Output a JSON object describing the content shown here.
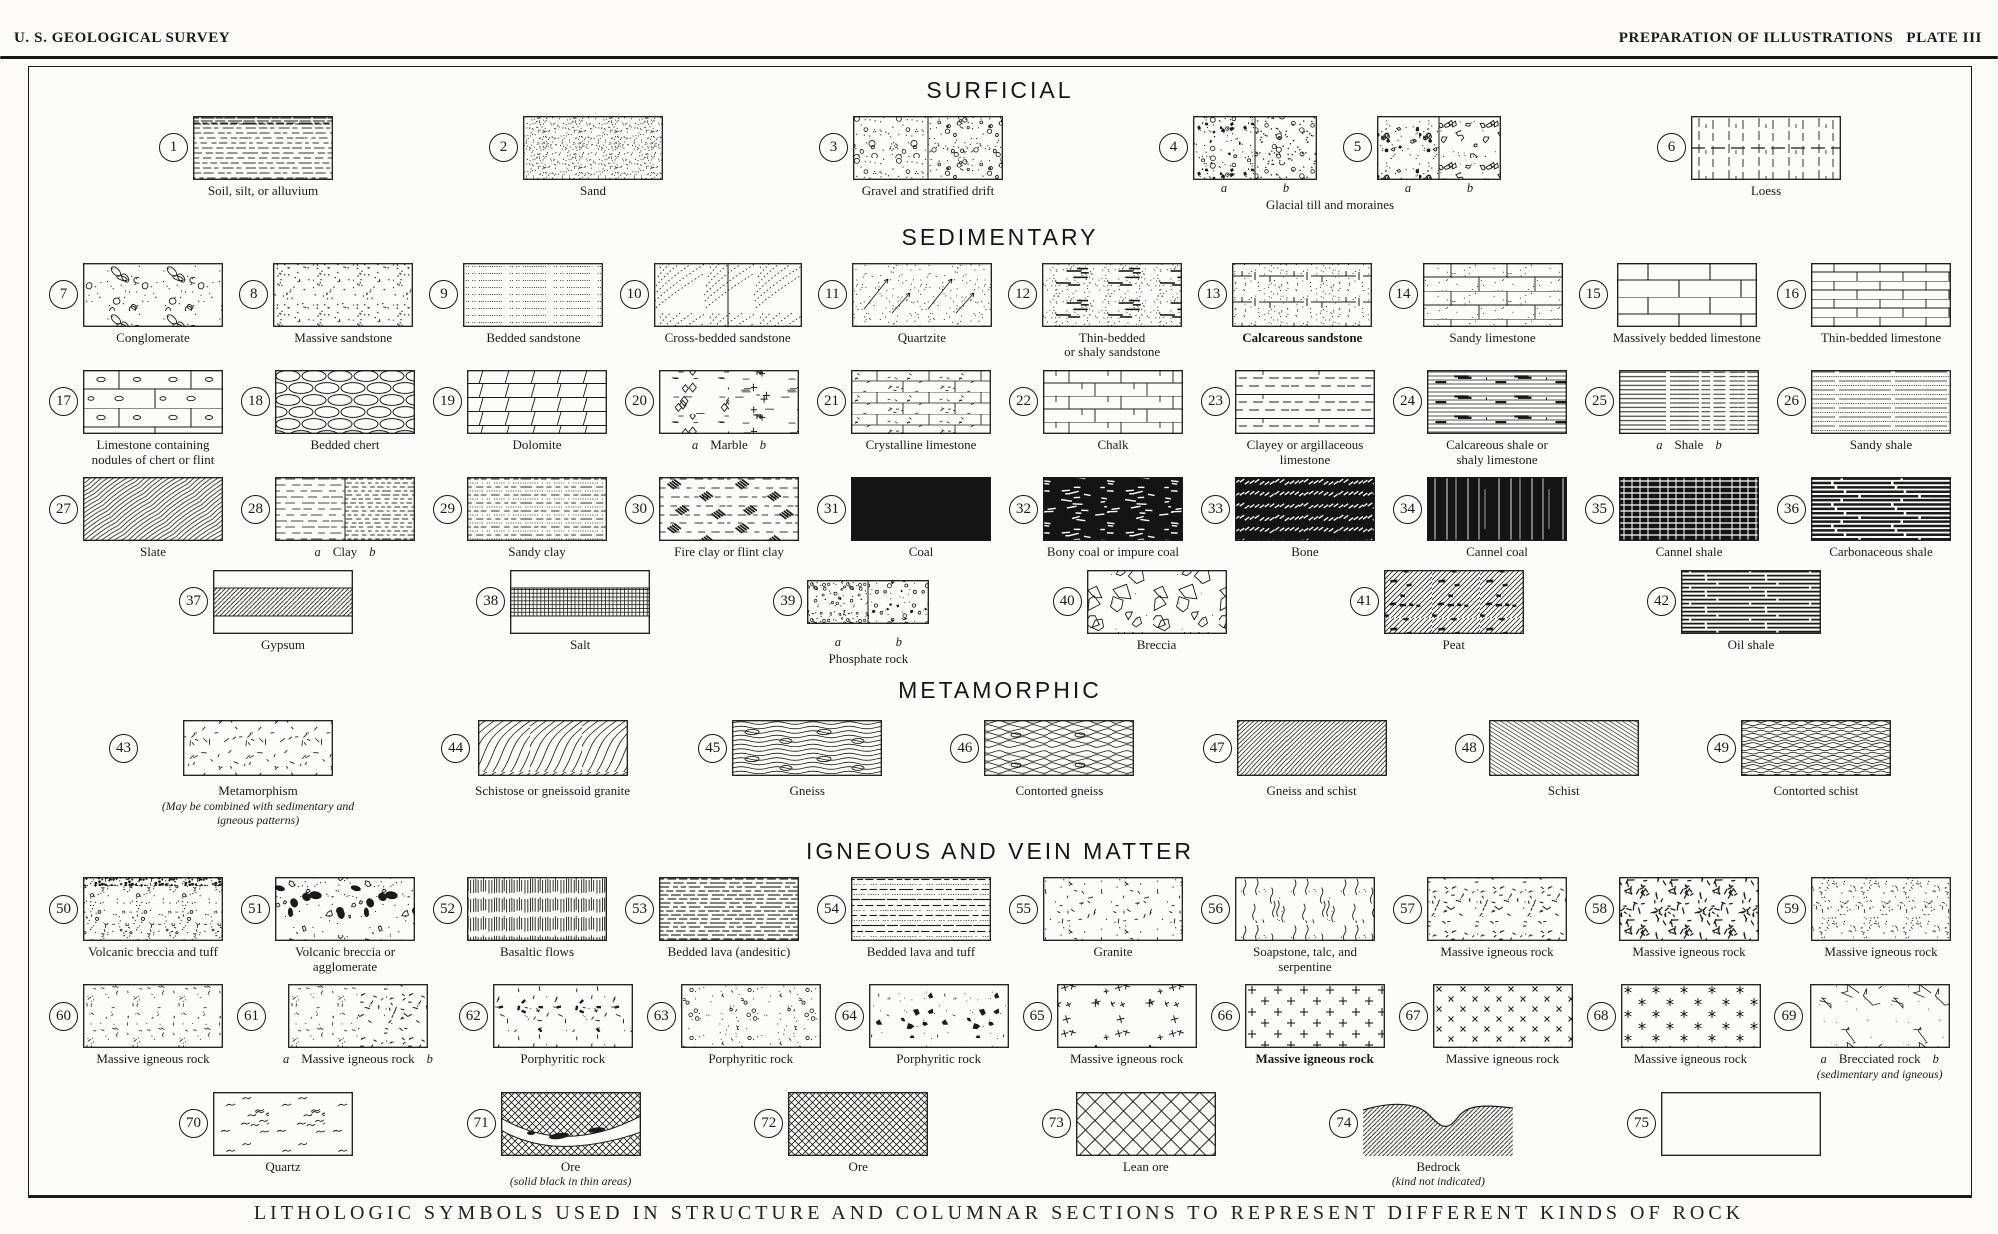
{
  "header": {
    "left": "U. S. GEOLOGICAL SURVEY",
    "right": "PREPARATION OF ILLUSTRATIONS   PLATE III"
  },
  "caption": "LITHOLOGIC SYMBOLS USED IN STRUCTURE AND COLUMNAR SECTIONS TO REPRESENT DIFFERENT KINDS OF ROCK",
  "ink_color": "#1a1a1a",
  "paper_color": "#fcfcfa",
  "sections": [
    {
      "title": "SURFICIAL",
      "rows": [
        [
          {
            "num": 1,
            "label": "Soil, silt, or alluvium",
            "patterns": [
              "soil"
            ],
            "top": "soilTop"
          },
          {
            "num": 2,
            "label": "Sand",
            "patterns": [
              "stipFine"
            ]
          },
          {
            "num": 3,
            "label": "Gravel and stratified drift",
            "split": true,
            "patterns": [
              "gravelA",
              "gravelB"
            ],
            "w": 150
          },
          {
            "pair": true,
            "label": "Glacial till and moraines",
            "items": [
              {
                "num": 4,
                "split": true,
                "ab": "row",
                "patterns": [
                  "tillA",
                  "tillB"
                ],
                "w": 124
              },
              {
                "num": 5,
                "split": true,
                "ab": "row",
                "patterns": [
                  "tillC",
                  "tillD"
                ],
                "w": 124
              }
            ]
          },
          {
            "num": 6,
            "label": "Loess",
            "patterns": [
              "loess"
            ],
            "mid": true,
            "w": 150
          }
        ]
      ]
    },
    {
      "title": "SEDIMENTARY",
      "rows": [
        [
          {
            "num": 7,
            "label": "Conglomerate",
            "patterns": [
              "conglom"
            ]
          },
          {
            "num": 8,
            "label": "Massive sandstone",
            "patterns": [
              "stipSparse"
            ]
          },
          {
            "num": 9,
            "label": "Bedded sandstone",
            "patterns": [
              "dotRows"
            ]
          },
          {
            "num": 10,
            "label": "Cross-bedded sandstone",
            "split": true,
            "patterns": [
              "crossbed",
              "crossbed"
            ],
            "w": 148
          },
          {
            "num": 11,
            "label": "Quartzite",
            "patterns": [
              "quartzite"
            ]
          },
          {
            "num": 12,
            "label": "Thin-bedded",
            "label2": "or shaly sandstone",
            "patterns": [
              "shalySS"
            ]
          },
          {
            "num": 13,
            "label": "Calcareous sandstone",
            "bold": true,
            "patterns": [
              "calcSS"
            ]
          },
          {
            "num": 14,
            "label": "Sandy limestone",
            "patterns": [
              "sandyLS"
            ]
          },
          {
            "num": 15,
            "label": "Massively bedded limestone",
            "patterns": [
              "brickL"
            ]
          },
          {
            "num": 16,
            "label": "Thin-bedded limestone",
            "patterns": [
              "brickT"
            ]
          }
        ],
        [
          {
            "num": 17,
            "label": "Limestone containing",
            "label2": "nodules of chert or flint",
            "patterns": [
              "brickNod"
            ]
          },
          {
            "num": 18,
            "label": "Bedded chert",
            "patterns": [
              "chert"
            ]
          },
          {
            "num": 19,
            "label": "Dolomite",
            "patterns": [
              "dolomite"
            ]
          },
          {
            "num": 20,
            "label": "Marble",
            "ab": "label",
            "split": true,
            "divider": false,
            "patterns": [
              "marbleA",
              "marbleB"
            ]
          },
          {
            "num": 21,
            "label": "Crystalline limestone",
            "patterns": [
              "crystLS"
            ]
          },
          {
            "num": 22,
            "label": "Chalk",
            "patterns": [
              "chalk"
            ]
          },
          {
            "num": 23,
            "label": "Clayey or argillaceous",
            "label2": "limestone",
            "patterns": [
              "clayeyLS"
            ]
          },
          {
            "num": 24,
            "label": "Calcareous shale or",
            "label2": "shaly limestone",
            "patterns": [
              "calcShale"
            ]
          },
          {
            "num": 25,
            "label": "Shale",
            "ab": "label",
            "split": true,
            "divider": false,
            "patterns": [
              "shaleA",
              "shaleB"
            ]
          },
          {
            "num": 26,
            "label": "Sandy shale",
            "patterns": [
              "sandyShale"
            ]
          }
        ],
        [
          {
            "num": 27,
            "label": "Slate",
            "patterns": [
              "slate"
            ]
          },
          {
            "num": 28,
            "label": "Clay",
            "ab": "label",
            "split": true,
            "patterns": [
              "clayA",
              "clayB"
            ]
          },
          {
            "num": 29,
            "label": "Sandy clay",
            "patterns": [
              "sandyClay"
            ]
          },
          {
            "num": 30,
            "label": "Fire clay or flint clay",
            "patterns": [
              "fireclay"
            ]
          },
          {
            "num": 31,
            "label": "Coal",
            "patterns": [
              "solid"
            ]
          },
          {
            "num": 32,
            "label": "Bony coal or impure coal",
            "patterns": [
              "bonyCoal"
            ]
          },
          {
            "num": 33,
            "label": "Bone",
            "patterns": [
              "bone"
            ]
          },
          {
            "num": 34,
            "label": "Cannel coal",
            "patterns": [
              "cannelC"
            ]
          },
          {
            "num": 35,
            "label": "Cannel shale",
            "patterns": [
              "cannelS"
            ]
          },
          {
            "num": 36,
            "label": "Carbonaceous shale",
            "patterns": [
              "carbShale"
            ]
          }
        ],
        [
          {
            "num": 37,
            "label": "Gypsum",
            "band": true,
            "patterns": [
              "diagBand"
            ]
          },
          {
            "num": 38,
            "label": "Salt",
            "band": true,
            "patterns": [
              "gridBand"
            ]
          },
          {
            "num": 39,
            "label": "Phosphate rock",
            "ab": "row",
            "split": true,
            "patterns": [
              "phosA",
              "phosB"
            ],
            "w": 122,
            "h": 44
          },
          {
            "num": 40,
            "label": "Breccia",
            "patterns": [
              "breccia"
            ]
          },
          {
            "num": 41,
            "label": "Peat",
            "patterns": [
              "peat"
            ]
          },
          {
            "num": 42,
            "label": "Oil shale",
            "patterns": [
              "oilShale"
            ]
          }
        ]
      ]
    },
    {
      "title": "METAMORPHIC",
      "rows": [
        [
          {
            "num": 43,
            "label": "Metamorphism",
            "note": "(May be combined with sedimentary and igneous patterns)",
            "patterns": [
              "metam"
            ],
            "w": 150,
            "h": 56
          },
          {
            "num": 44,
            "label": "Schistose or gneissoid granite",
            "patterns": [
              "schGran"
            ],
            "w": 150,
            "h": 56
          },
          {
            "num": 45,
            "label": "Gneiss",
            "patterns": [
              "gneiss"
            ],
            "w": 150,
            "h": 56
          },
          {
            "num": 46,
            "label": "Contorted gneiss",
            "patterns": [
              "contGneiss"
            ],
            "w": 150,
            "h": 56
          },
          {
            "num": 47,
            "label": "Gneiss and schist",
            "patterns": [
              "gneissSch"
            ],
            "w": 150,
            "h": 56
          },
          {
            "num": 48,
            "label": "Schist",
            "patterns": [
              "schist"
            ],
            "w": 150,
            "h": 56
          },
          {
            "num": 49,
            "label": "Contorted schist",
            "patterns": [
              "contSchist"
            ],
            "w": 150,
            "h": 56
          }
        ]
      ]
    },
    {
      "title": "IGNEOUS AND VEIN MATTER",
      "rows": [
        [
          {
            "num": 50,
            "label": "Volcanic breccia and tuff",
            "patterns": [
              "vtuff"
            ],
            "top": "vtuffTop"
          },
          {
            "num": 51,
            "label": "Volcanic breccia or",
            "label2": "agglomerate",
            "patterns": [
              "agglom"
            ]
          },
          {
            "num": 52,
            "label": "Basaltic flows",
            "patterns": [
              "basalt"
            ]
          },
          {
            "num": 53,
            "label": "Bedded lava (andesitic)",
            "patterns": [
              "lavaA"
            ]
          },
          {
            "num": 54,
            "label": "Bedded lava and tuff",
            "patterns": [
              "lavaTuff"
            ]
          },
          {
            "num": 55,
            "label": "Granite",
            "patterns": [
              "granite"
            ]
          },
          {
            "num": 56,
            "label": "Soapstone, talc, and",
            "label2": "serpentine",
            "patterns": [
              "soap"
            ]
          },
          {
            "num": 57,
            "label": "Massive igneous rock",
            "patterns": [
              "mig57"
            ]
          },
          {
            "num": 58,
            "label": "Massive igneous rock",
            "patterns": [
              "mig58"
            ]
          },
          {
            "num": 59,
            "label": "Massive igneous rock",
            "patterns": [
              "mig59"
            ]
          }
        ],
        [
          {
            "num": 60,
            "label": "Massive igneous rock",
            "patterns": [
              "mig60"
            ]
          },
          {
            "num": 61,
            "label": "Massive igneous rock",
            "ab": "label",
            "split": true,
            "divider": false,
            "patterns": [
              "mig60",
              "mig57"
            ]
          },
          {
            "num": 62,
            "label": "Porphyritic rock",
            "patterns": [
              "porph62"
            ]
          },
          {
            "num": 63,
            "label": "Porphyritic rock",
            "patterns": [
              "porph63"
            ]
          },
          {
            "num": 64,
            "label": "Porphyritic rock",
            "patterns": [
              "porph64"
            ]
          },
          {
            "num": 65,
            "label": "Massive igneous rock",
            "patterns": [
              "plusScat"
            ]
          },
          {
            "num": 66,
            "label": "Massive igneous rock",
            "bold": true,
            "patterns": [
              "plusGrid"
            ]
          },
          {
            "num": 67,
            "label": "Massive igneous rock",
            "patterns": [
              "xRows"
            ]
          },
          {
            "num": 68,
            "label": "Massive igneous rock",
            "patterns": [
              "starRows"
            ]
          },
          {
            "num": 69,
            "label": "Brecciated rock",
            "ab": "label",
            "note": "(sedimentary and igneous)",
            "patterns": [
              "crackle"
            ]
          }
        ],
        [
          {
            "num": 70,
            "label": "Quartz",
            "patterns": [
              "quartz"
            ]
          },
          {
            "num": 71,
            "label": "Ore",
            "note": "(solid black in thin areas)",
            "special": "ore",
            "patterns": [
              "xhatch"
            ]
          },
          {
            "num": 72,
            "label": "Ore",
            "patterns": [
              "xhatch"
            ]
          },
          {
            "num": 73,
            "label": "Lean ore",
            "patterns": [
              "leanOre"
            ]
          },
          {
            "num": 74,
            "label": "Bedrock",
            "note": "(kind not indicated)",
            "special": "bedrock",
            "patterns": [
              "diagBand"
            ],
            "w": 150
          },
          {
            "num": 75,
            "label": "",
            "special": "blank",
            "patterns": [],
            "w": 160
          }
        ]
      ]
    }
  ]
}
